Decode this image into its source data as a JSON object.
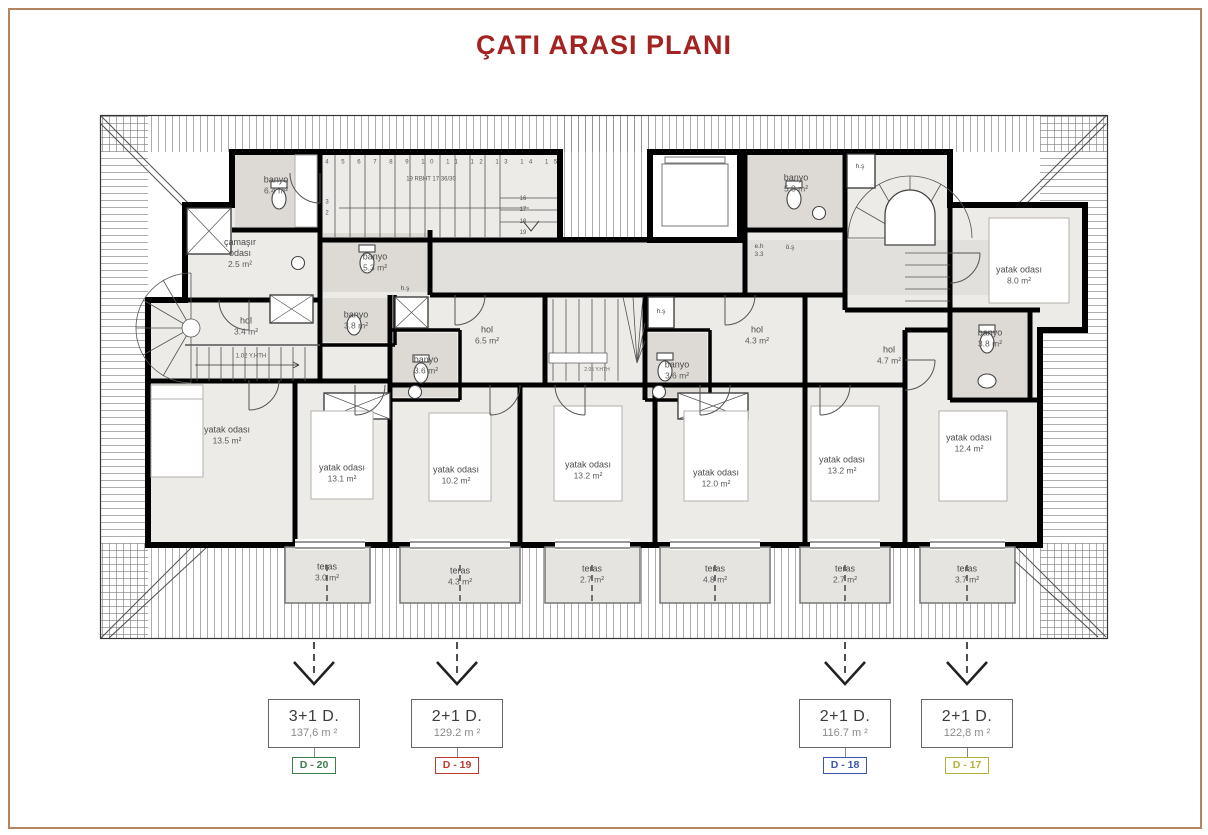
{
  "title": "ÇATI ARASI PLANI",
  "colors": {
    "title": "#a32222",
    "frame": "#b4835f",
    "d20": "#3e7d4e",
    "d19": "#c03a34",
    "d18": "#3a57ad",
    "d17": "#b9b23a"
  },
  "rooms": {
    "banyo64": {
      "name": "banyo",
      "area": "6.4 m²"
    },
    "camasir": {
      "name": "çamaşır\nodası",
      "area": "2.5 m²"
    },
    "banyo53": {
      "name": "banyo",
      "area": "5.3 m²"
    },
    "hs1": {
      "name": "h.ş",
      "area": ""
    },
    "banyo38l": {
      "name": "banyo",
      "area": "3.8 m²"
    },
    "hol34": {
      "name": "hol",
      "area": "3.4 m²"
    },
    "banyo36a": {
      "name": "banyo",
      "area": "3.6 m²"
    },
    "hol65": {
      "name": "hol",
      "area": "6.5 m²"
    },
    "banyo36b": {
      "name": "banyo",
      "area": "3.6 m²"
    },
    "hs2": {
      "name": "h.ş",
      "area": ""
    },
    "hol43": {
      "name": "hol",
      "area": "4.3 m²"
    },
    "banyo58": {
      "name": "banyo",
      "area": "5.8 m²"
    },
    "eh": {
      "name": "e.h",
      "area": "3.3"
    },
    "os": {
      "name": "ö.ş",
      "area": ""
    },
    "hs3": {
      "name": "h.ş",
      "area": ""
    },
    "hol47": {
      "name": "hol",
      "area": "4.7 m²"
    },
    "yatak80": {
      "name": "yatak odası",
      "area": "8.0 m²"
    },
    "banyo38r": {
      "name": "banyo",
      "area": "3.8 m²"
    },
    "yatak135": {
      "name": "yatak odası",
      "area": "13.5 m²"
    },
    "yatak131": {
      "name": "yatak odası",
      "area": "13.1 m²"
    },
    "yatak102": {
      "name": "yatak odası",
      "area": "10.2 m²"
    },
    "yatak132a": {
      "name": "yatak odası",
      "area": "13.2 m²"
    },
    "yatak120": {
      "name": "yatak odası",
      "area": "12.0 m²"
    },
    "yatak132b": {
      "name": "yatak odası",
      "area": "13.2 m²"
    },
    "yatak124": {
      "name": "yatak odası",
      "area": "12.4 m²"
    },
    "teras30": {
      "name": "teras",
      "area": "3.0 m²"
    },
    "teras43": {
      "name": "teras",
      "area": "4.3 m²"
    },
    "teras27a": {
      "name": "teras",
      "area": "2.7 m²"
    },
    "teras48": {
      "name": "teras",
      "area": "4.8 m²"
    },
    "teras27b": {
      "name": "teras",
      "area": "2.7 m²"
    },
    "teras37": {
      "name": "teras",
      "area": "3.7 m²"
    }
  },
  "stairs": {
    "note_top": "19 RBHT 17.36/30",
    "note_left": "1.02 Y.HTH",
    "note_mid": "2.05 Y.HTH",
    "treads_top": "4 5 6 7 8 9 10 11 12 13 14 15",
    "treads_right": "16\n17\n18\n19",
    "treads_left": "3\n2"
  },
  "units": [
    {
      "type": "3+1 D.",
      "area": "137,6 m ²",
      "id": "D - 20"
    },
    {
      "type": "2+1 D.",
      "area": "129.2 m ²",
      "id": "D - 19"
    },
    {
      "type": "2+1 D.",
      "area": "116.7 m ²",
      "id": "D - 18"
    },
    {
      "type": "2+1 D.",
      "area": "122,8 m ²",
      "id": "D - 17"
    }
  ]
}
